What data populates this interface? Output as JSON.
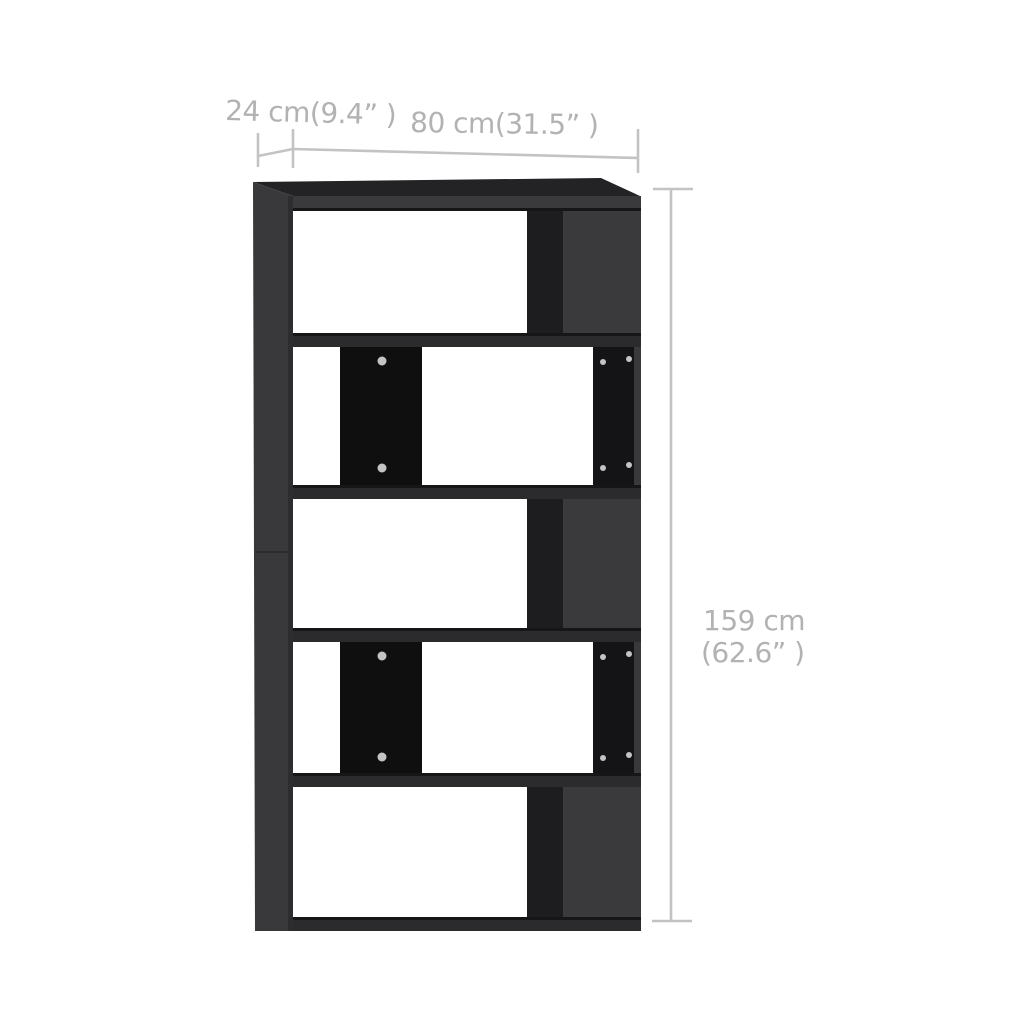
{
  "diagram": {
    "type": "product-dimension-diagram",
    "item": "book-cabinet-room-divider",
    "item_color": "black",
    "shelf_rows": 5,
    "labels": {
      "depth": "24 cm(9.4”  )",
      "width": "80 cm(31.5”  )",
      "height_cm": "159 cm",
      "height_in": "(62.6”  )"
    }
  },
  "colors": {
    "background": "#ffffff",
    "face": "#3a3a3c",
    "face-top": "#232325",
    "face-side": "#39393b",
    "side-edge": "#2d2d2f",
    "band": "#2b2b2d",
    "edge": "#161618",
    "inner": "#1d1d1f",
    "divider": "#0f0f10",
    "panel": "#141416",
    "sliver": "#39393b",
    "screw": "#c4c4c4",
    "dim-line": "#c3c3c3",
    "dim-text": "#b2b2b2"
  }
}
